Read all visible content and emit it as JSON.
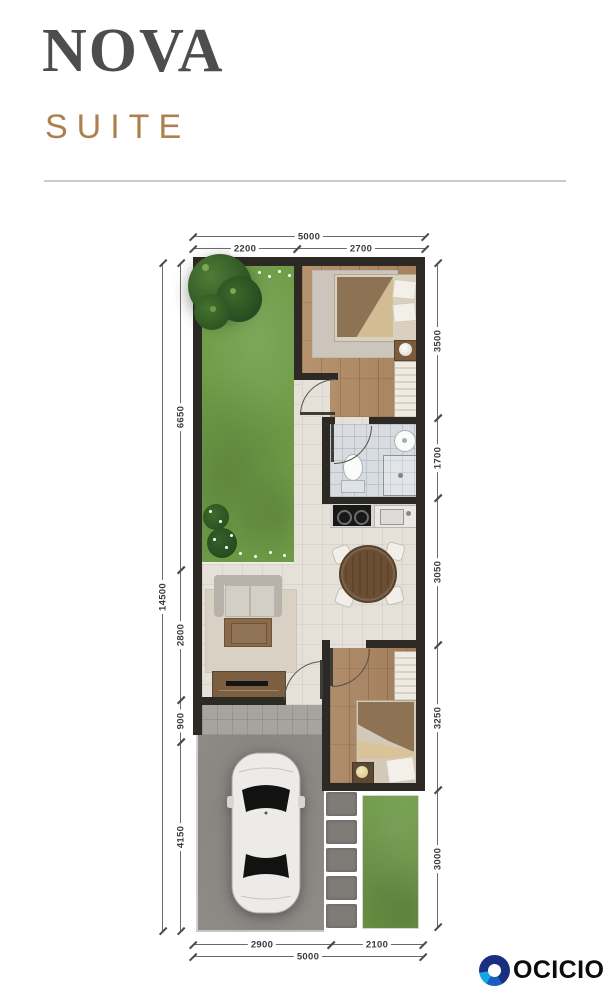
{
  "header": {
    "title": "NOVA",
    "subtitle": "SUITE"
  },
  "dimensions": {
    "top": {
      "overall": "5000",
      "segments": [
        "2200",
        "2700"
      ]
    },
    "bottom": {
      "overall": "5000",
      "segments": [
        "2900",
        "2100"
      ]
    },
    "left": {
      "overall": "14500",
      "segments": [
        "6650",
        "2800",
        "900",
        "4150"
      ]
    },
    "right": {
      "segments": [
        "3500",
        "1700",
        "3050",
        "3250",
        "3000"
      ]
    }
  },
  "brand": {
    "name": "OCICIO"
  },
  "colors": {
    "title_text": "#4d4d4f",
    "subtitle_accent": "#ad8050",
    "wall": "#2d2a26",
    "garden_green": "#6f9c47",
    "wood_floor": "#b08a63",
    "logo_navy": "#1b2f80",
    "logo_blue": "#1a5fc0",
    "logo_cyan": "#15a5e2"
  }
}
